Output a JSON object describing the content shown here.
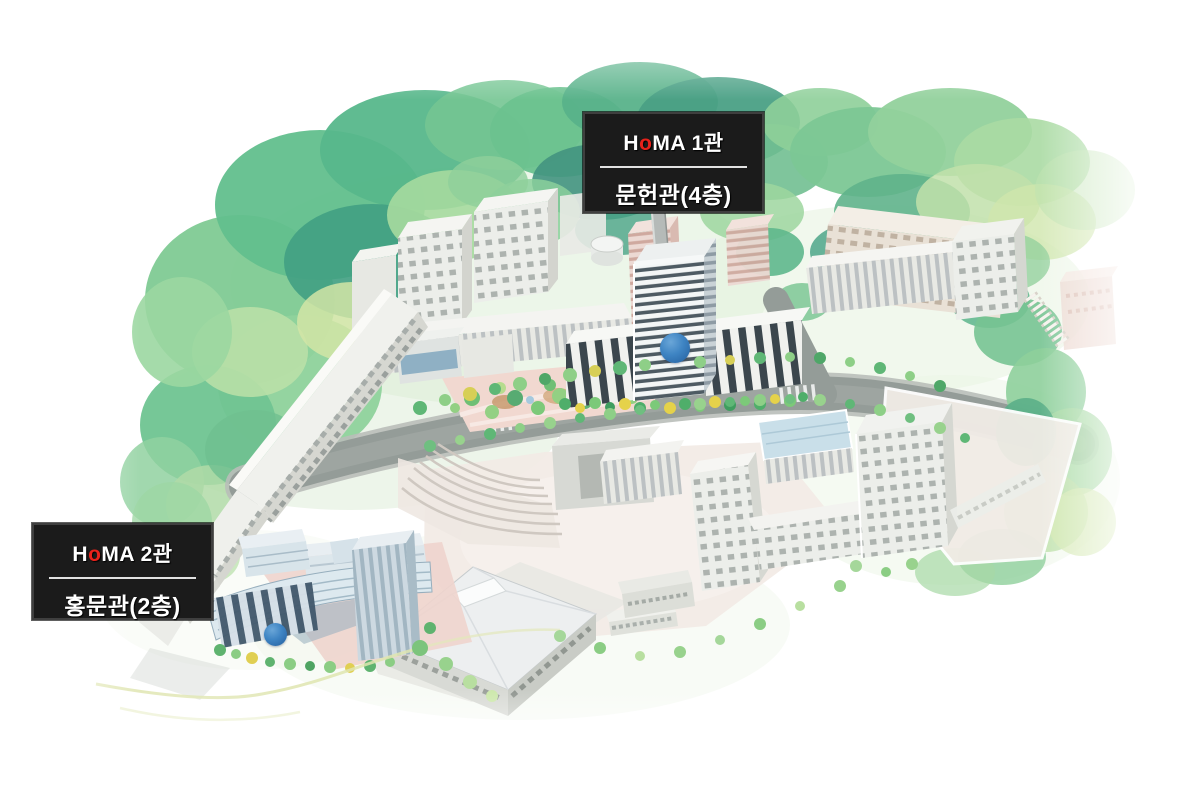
{
  "labels": {
    "homa1": {
      "brand_pre": "H",
      "brand_accent": "o",
      "brand_post": "MA 1관",
      "building": "문헌관(4층)"
    },
    "homa2": {
      "brand_pre": "H",
      "brand_accent": "o",
      "brand_post": "MA 2관",
      "building": "홍문관(2층)"
    }
  },
  "markers": [
    {
      "id": "homa1",
      "color": "#3b80c0"
    },
    {
      "id": "homa2",
      "color": "#3b80c0"
    }
  ],
  "colors": {
    "page_background": "#ffffff",
    "label_background": "#1b1b1b",
    "label_border": "#3f3f3f",
    "label_text": "#ffffff",
    "brand_accent_red": "#e7221b",
    "divider": "#e2e2e2",
    "marker_blue": "#3b80c0",
    "road_gray": "#949c98",
    "tree_green": "#62bf8d",
    "plaza_pink": "#f2ece7"
  }
}
